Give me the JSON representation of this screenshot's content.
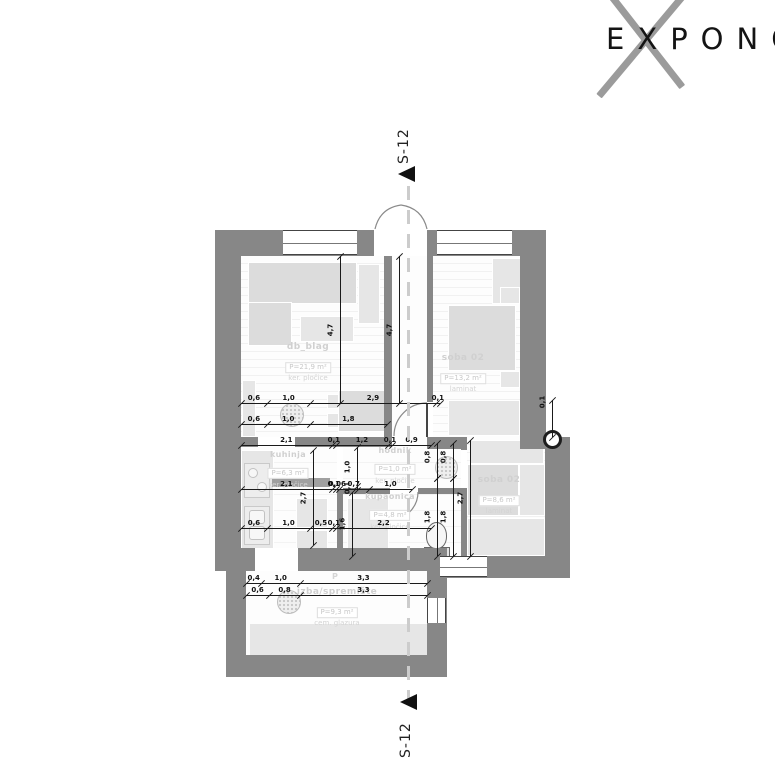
{
  "logo": {
    "text": "EXPONO"
  },
  "section_marker": {
    "top": "S-12",
    "bottom": "S-12"
  },
  "rooms": [
    {
      "name": "db_blag",
      "area": "P=21,9 m²",
      "floor": "ker. pločice"
    },
    {
      "name": "soba 02",
      "area": "P=13,2 m²",
      "floor": "laminat"
    },
    {
      "name": "kuhinja",
      "area": "P=6,3 m²",
      "floor": "ker. pločice"
    },
    {
      "name": "hodnik",
      "area": "P=1,0 m²",
      "floor": "ker. pločice"
    },
    {
      "name": "kupaonica",
      "area": "P=4,8 m²",
      "floor": "ker. pločice"
    },
    {
      "name": "soba 02",
      "area": "P=8,6 m²",
      "floor": "laminat"
    },
    {
      "name": "izba/spremište",
      "area": "P=9,3 m²",
      "floor": "cem. glazura"
    }
  ],
  "entry_marker": "P",
  "dims": {
    "top_a": [
      "0,6",
      "1,0",
      "2,9",
      "0,1"
    ],
    "top_b": [
      "0,6",
      "1,0",
      "1,8"
    ],
    "v_blag": [
      "4,7"
    ],
    "v_corridor": [
      "4,7"
    ],
    "mid_a": [
      "2,1",
      "0,1",
      "1,2",
      "0,1",
      "0,9"
    ],
    "mid_b": [
      "2,1",
      "0,1",
      "0,06",
      "0,7",
      "1,0"
    ],
    "v_kuhinja": [
      "2,7"
    ],
    "v_hodnik": [
      "1,0",
      "0,1"
    ],
    "low": [
      "0,6",
      "1,0",
      "0,5",
      "0,1",
      "2,2"
    ],
    "v_bath": [
      "1,6"
    ],
    "v_left18": [
      "1,8"
    ],
    "v_right18": [
      "1,8"
    ],
    "v_left08": [
      "0,8"
    ],
    "v_right08": [
      "0,8"
    ],
    "v_soba_mid": [
      "2,7"
    ],
    "izba_a": [
      "0,4",
      "1,0",
      "3,3"
    ],
    "izba_b": [
      "0,6",
      "0,8",
      "3,3"
    ],
    "v_wall_right": [
      "0,1"
    ]
  }
}
